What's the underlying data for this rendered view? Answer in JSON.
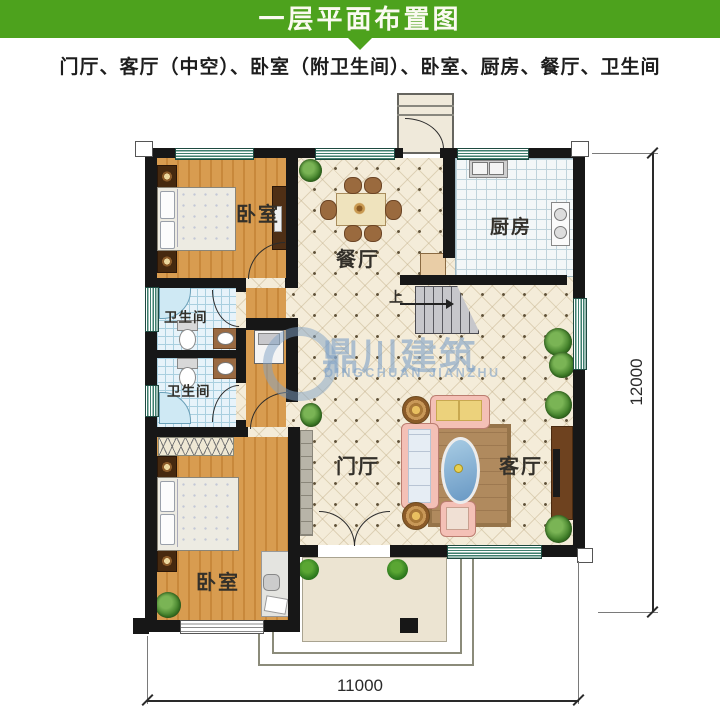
{
  "header": {
    "title": "一层平面布置图",
    "bg_color": "#4da21d"
  },
  "subtitle": "门厅、客厅（中空）、卧室（附卫生间）、卧室、厨房、餐厅、卫生间",
  "rooms": {
    "bedroom_top": {
      "label": "卧室"
    },
    "dining": {
      "label": "餐厅"
    },
    "kitchen": {
      "label": "厨房"
    },
    "bath_upper": {
      "label": "卫生间"
    },
    "bath_lower": {
      "label": "卫生间"
    },
    "bedroom_bottom": {
      "label": "卧室"
    },
    "foyer": {
      "label": "门厅"
    },
    "living": {
      "label": "客厅"
    }
  },
  "stairs": {
    "direction_label": "上"
  },
  "dimensions": {
    "width": "11000",
    "depth": "12000"
  },
  "watermark": {
    "name_cn": "鼎川建筑",
    "name_en": "DINGCHUAN JIANZHU"
  },
  "colors": {
    "header_green": "#4da21d",
    "wall_black": "#171717",
    "wood_floor": "#d0924a",
    "tile_cream": "#f4ecd9",
    "window_teal": "#3e7f6e",
    "watermark_blue": "#82a5c8"
  }
}
